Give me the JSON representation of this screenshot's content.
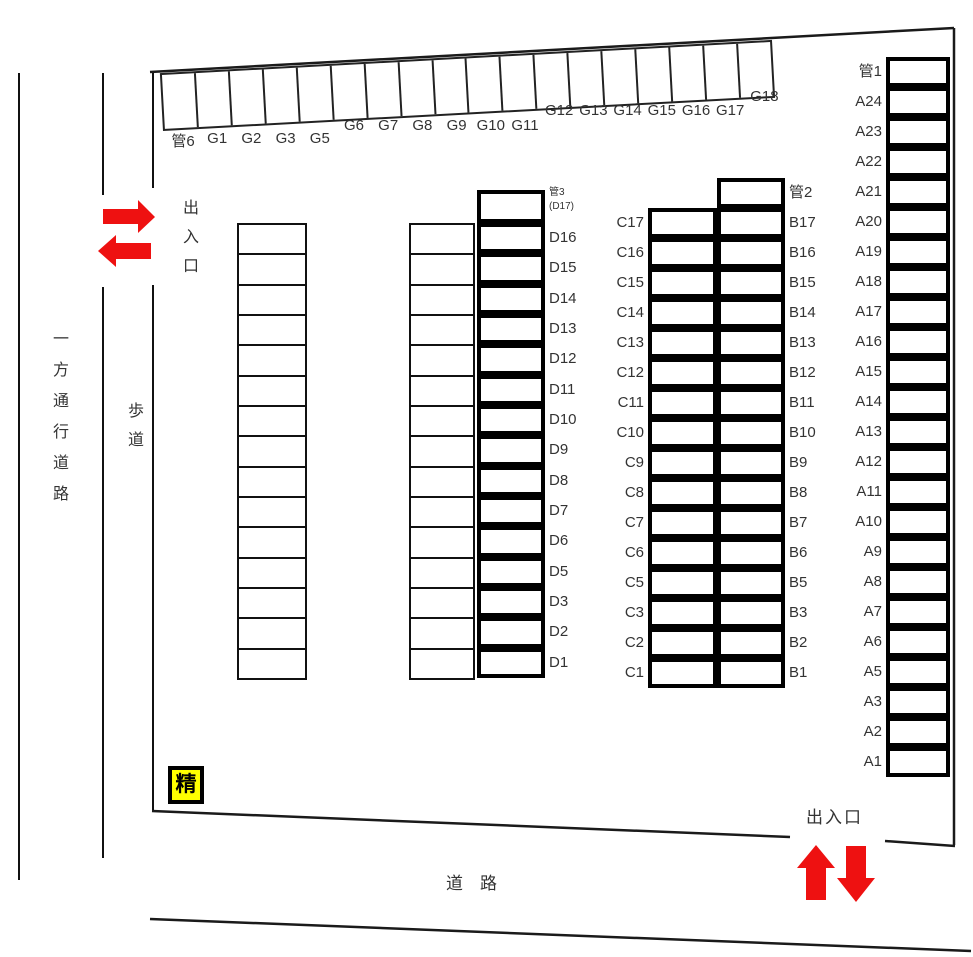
{
  "labels": {
    "one_way_road": "一方通行道路",
    "sidewalk": "歩道",
    "left_entrance": "出入口",
    "bottom_entrance": "出入口",
    "road": "道　路",
    "badge": "精"
  },
  "colors": {
    "line": "#111111",
    "label": "#333333",
    "arrow": "#ee1111",
    "badge_bg": "#ffff00",
    "badge_border": "#000000"
  },
  "g_row": [
    "管6",
    "G1",
    "G2",
    "G3",
    "G5",
    "G6",
    "G7",
    "G8",
    "G9",
    "G10",
    "G11",
    "G12",
    "G13",
    "G14",
    "G15",
    "G16",
    "G17",
    "G18"
  ],
  "a_column": [
    "管1",
    "A24",
    "A23",
    "A22",
    "A21",
    "A20",
    "A19",
    "A18",
    "A17",
    "A16",
    "A15",
    "A14",
    "A13",
    "A12",
    "A11",
    "A10",
    "A9",
    "A8",
    "A7",
    "A6",
    "A5",
    "A3",
    "A2",
    "A1"
  ],
  "b_column": {
    "top": "管2",
    "slots": [
      "B17",
      "B16",
      "B15",
      "B14",
      "B13",
      "B12",
      "B11",
      "B10",
      "B9",
      "B8",
      "B7",
      "B6",
      "B5",
      "B3",
      "B2",
      "B1"
    ]
  },
  "c_column": [
    "C17",
    "C16",
    "C15",
    "C14",
    "C13",
    "C12",
    "C11",
    "C10",
    "C9",
    "C8",
    "C7",
    "C6",
    "C5",
    "C3",
    "C2",
    "C1"
  ],
  "d_column": {
    "top": "管3",
    "top_sub": "(D17)",
    "slots": [
      "D16",
      "D15",
      "D14",
      "D13",
      "D12",
      "D11",
      "D10",
      "D9",
      "D8",
      "D7",
      "D6",
      "D5",
      "D3",
      "D2",
      "D1"
    ]
  },
  "unlabeled_columns": {
    "far_left_rows": 15,
    "mid_rows": 15
  }
}
